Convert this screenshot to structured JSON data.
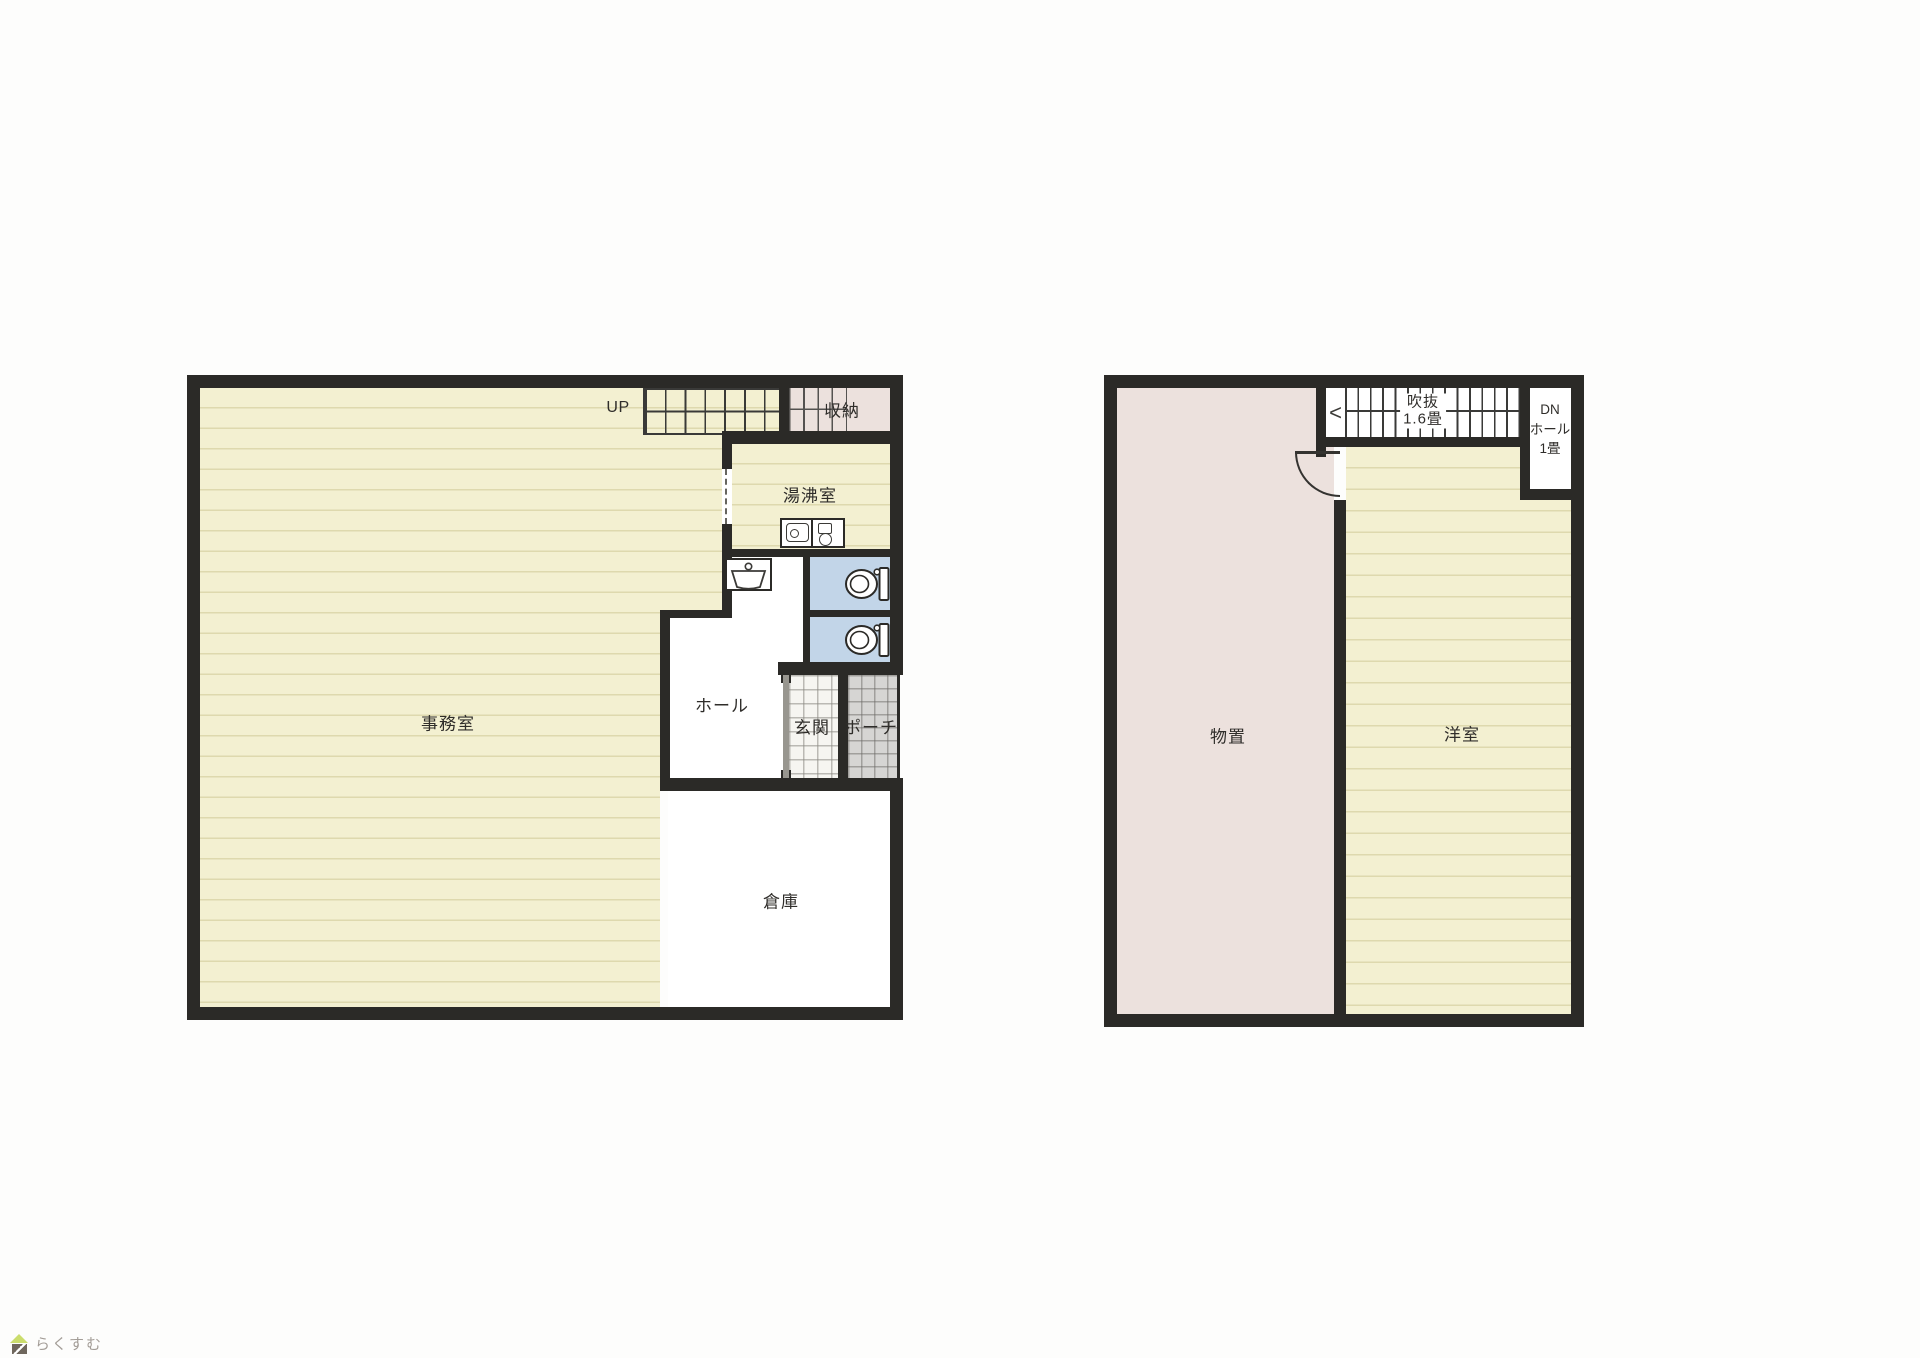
{
  "branding": {
    "logo_text": "らくすむ"
  },
  "floor1": {
    "office": "事務室",
    "hall": "ホール",
    "entrance": "玄関",
    "porch": "ポーチ",
    "warehouse": "倉庫",
    "kitchenette": "湯沸室",
    "closet": "収納",
    "stairs_up": "UP"
  },
  "floor2": {
    "storage": "物置",
    "western_room": "洋室",
    "atrium_line1": "吹抜",
    "atrium_line2": "1.6畳",
    "down_hall_line1": "DN",
    "down_hall_line2": "ホール",
    "down_hall_line3": "1畳",
    "stair_arrow": "<"
  },
  "icons": {
    "stair-direction-arrow": "chevron-left",
    "toilet-icon": "toilet bowl with tank",
    "washbasin-icon": "hand wash basin",
    "kitchen-sink-icon": "sink counter with heater",
    "house-logo-icon": "small house"
  },
  "colors": {
    "wall": "#2b2a27",
    "line": "#3a3a38",
    "ink": "#2f2d2a",
    "tatami": "#f3f0d1",
    "tatami-line": "#ded9ae",
    "pink": "#ece1dd",
    "blue": "#c2d5e8",
    "tile-light": "#f6f5f1",
    "tile-dark": "#d6d5d3",
    "logo-text": "#a39d97",
    "logo-green": "#cbdd6d",
    "logo-base": "#6f675d"
  }
}
